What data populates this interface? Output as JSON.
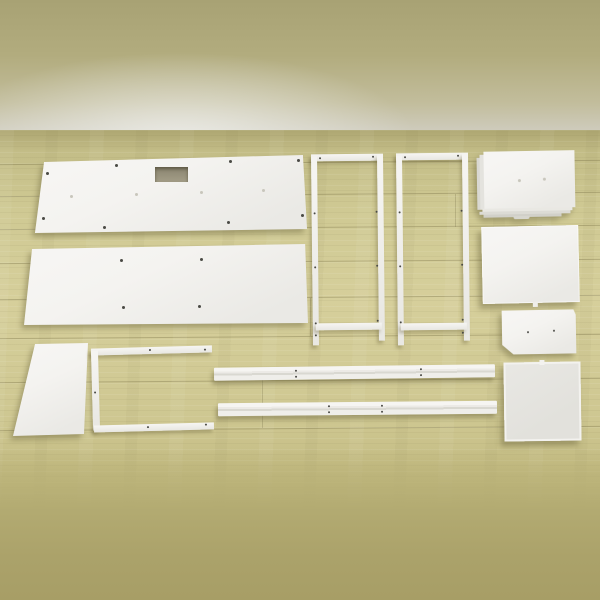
{
  "meta": {
    "description": "Overhead product photo of white flat-pack furniture parts laid out on a pale oak wood floor against an olive wall; no text anywhere in the image",
    "scene": "furniture assembly parts flat lay"
  },
  "palette": {
    "wall_top": "#a8a274",
    "wall_light": "#d9d8d0",
    "floor_base": "#cbc48e",
    "floor_light": "#d6cf9b",
    "floor_seam": "#7a7248",
    "foreground_blur": "#a79e66",
    "part_white": "#f4f3f0",
    "part_shadow": "rgba(105,98,58,0.45)",
    "hole_dark": "#4a4a45",
    "hole_faint": "#c8c6bc",
    "cutout_dark": "#8a8570"
  },
  "parts": [
    {
      "id": "panel-long-top",
      "label": "long back panel with handle cutout",
      "holes_dark": 8,
      "holes_faint": 4
    },
    {
      "id": "panel-long-bottom",
      "label": "long back panel",
      "holes_dark": 4
    },
    {
      "id": "side-frame-left",
      "label": "tall side frame with legs"
    },
    {
      "id": "side-frame-right",
      "label": "tall side frame with legs"
    },
    {
      "id": "shelf-stack",
      "label": "stack of white shelf boards",
      "holes_faint": 2
    },
    {
      "id": "square-panel-top",
      "label": "square side panel with bottom tab"
    },
    {
      "id": "small-panel-right",
      "label": "small mounting panel",
      "holes_dark": 2
    },
    {
      "id": "square-panel-bottom",
      "label": "square framed panel with top notch"
    },
    {
      "id": "small-panel-left",
      "label": "small rectangular panel"
    },
    {
      "id": "u-frame",
      "label": "U-shaped support frame",
      "holes_dark": 5
    },
    {
      "id": "rail-top",
      "label": "long support rail",
      "holes_dark": 4
    },
    {
      "id": "rail-bottom",
      "label": "long support rail",
      "holes_dark": 4
    }
  ]
}
